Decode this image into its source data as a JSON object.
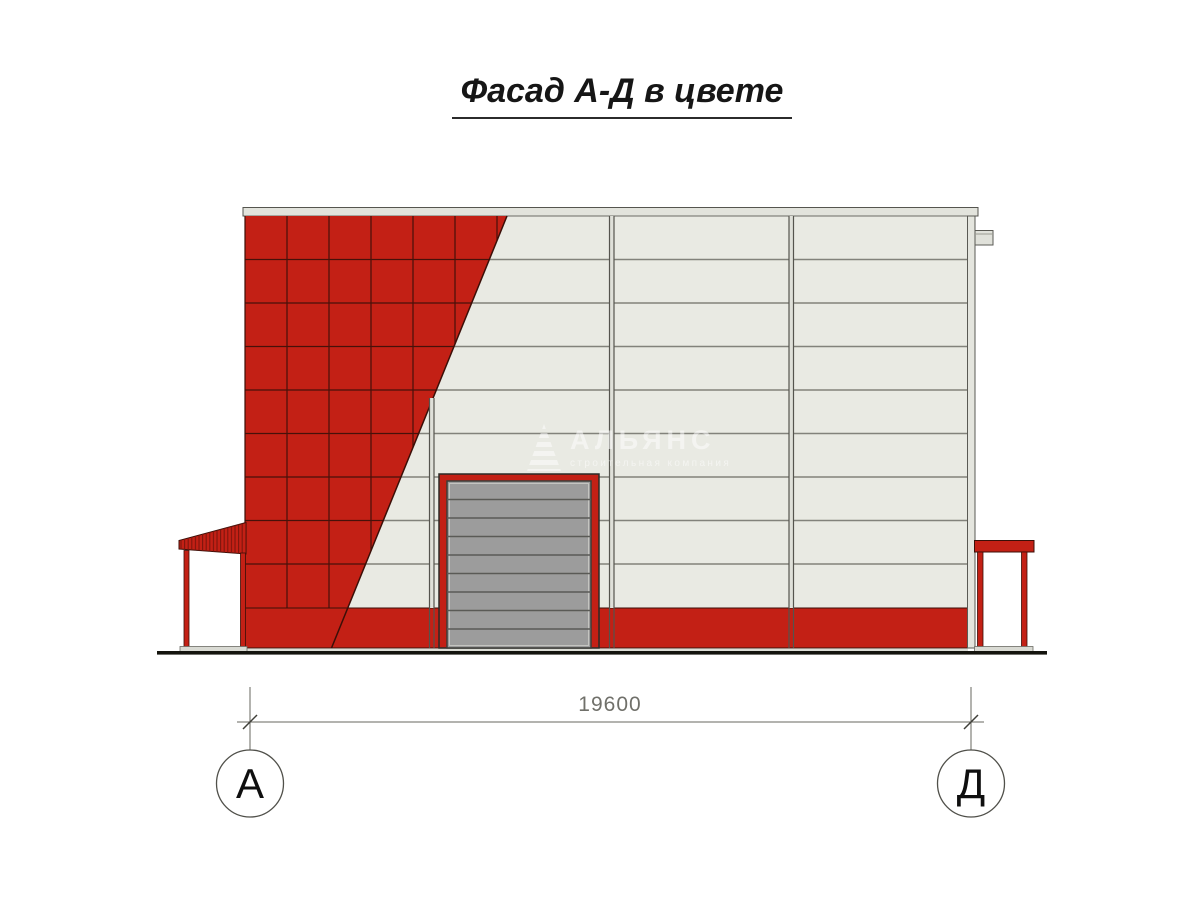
{
  "title": {
    "text": "Фасад А-Д в цвете"
  },
  "drawing": {
    "type": "architectural-facade-elevation",
    "dimension_label": "19600",
    "axis_markers": [
      {
        "label": "А"
      },
      {
        "label": "Д"
      }
    ],
    "watermark": {
      "brand": "АЛЬЯНС",
      "tagline": "строительная компания",
      "icon": "pyramid-icon"
    },
    "colors": {
      "facade_red": "#C32015",
      "tile_joint_dark": "#47110A",
      "wall_panel": "#E9EAE3",
      "wall_joint": "#82827B",
      "coping_gray": "#E2E3DC",
      "door_gray": "#9C9C9C",
      "door_joint": "#5A5A56",
      "canopy_foundation": "#D9DAD3",
      "ground_black": "#14140E",
      "dimension_gray": "#70706A",
      "drawing_outline": "#3B0F08"
    }
  }
}
